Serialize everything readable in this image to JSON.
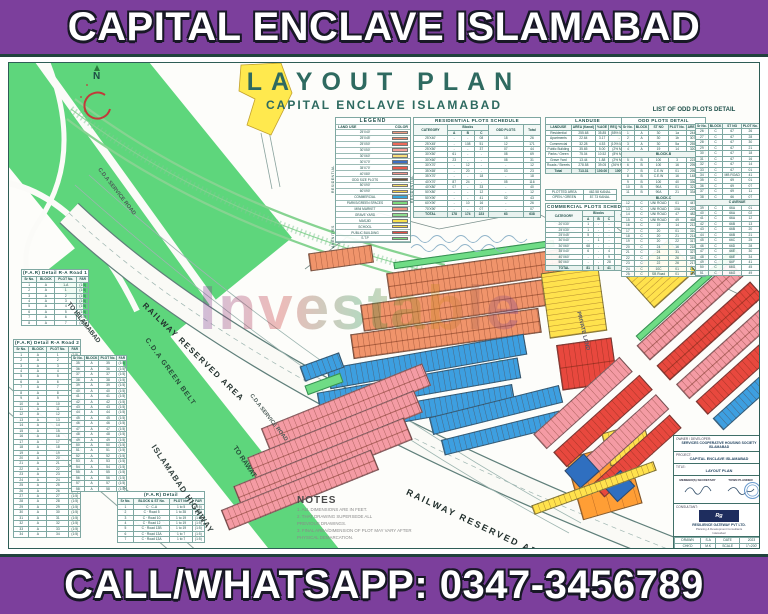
{
  "colors": {
    "banner_purple": "#7c3f9c",
    "frame_teal": "#2e5d56",
    "title_teal": "#2e6a60",
    "belt_green": "#5ed67c",
    "plot_orange": "#F0946B",
    "plot_blue": "#3D9FE0",
    "plot_yellow": "#FFE24D",
    "plot_pink": "#F49BA4",
    "plot_red": "#E8483E",
    "commercial_blue": "#2F6FC0",
    "parcel_orange": "#FF9E35"
  },
  "header": {
    "title": "CAPITAL ENCLAVE ISLAMABAD"
  },
  "footer": {
    "phone_line": "CALL/WHATSAPP: 0347-3456789"
  },
  "map": {
    "title": "LAYOUT PLAN",
    "subtitle": "CAPITAL ENCLAVE ISLAMABAD",
    "north_label": "N",
    "watermark": "Investable",
    "labels": {
      "to_islamabad": "TO ISLAMABAD",
      "service_road_upper": "C.D.A  SERVICE  ROAD",
      "railway_upper": "RAILWAY RESERVED AREA",
      "green_belt": "C.D.A  GREEN  BELT",
      "to_rawat": "TO RAWAT",
      "highway": "ISLAMABAD  HIGHWAY",
      "service_road_lower": "C.D.A  SERVICE  ROAD",
      "railway_lower": "RAILWAY RESERVED AREA",
      "private_land": "PRIVATE LAND"
    }
  },
  "legend": {
    "title": "LEGEND",
    "col1": "LAND USE",
    "col2": "COLOR",
    "group_residential": "RESIDENTIAL",
    "group_amenities": "AMENITIES",
    "rows": [
      {
        "label": "25'X40'",
        "color": "#F29B83"
      },
      {
        "label": "25'X45'",
        "color": "#F28F76"
      },
      {
        "label": "25'X50'",
        "color": "#EE6A5A"
      },
      {
        "label": "30'X50'",
        "color": "#F4A09A"
      },
      {
        "label": "30'X60'",
        "color": "#F7DE7A"
      },
      {
        "label": "30'X70'",
        "color": "#3D6FC2"
      },
      {
        "label": "35'X70'",
        "color": "#E85C4E"
      },
      {
        "label": "40'X80'",
        "color": "#F2978D"
      },
      {
        "label": "ODD SIZE PLOTS",
        "color": "#6B5335"
      },
      {
        "label": "50'X90'",
        "color": "#F7E06A"
      },
      {
        "label": "60'X90'",
        "color": "#F2D14F"
      },
      {
        "label": "COMMERCIAL",
        "color": "#35A7DC"
      },
      {
        "label": "PARKS/GREEN SPACES",
        "color": "#7CD97C"
      },
      {
        "label": "MINI MARKET",
        "color": "#F2937C"
      },
      {
        "label": "GRAVE YARD",
        "color": "#8FDC8F"
      },
      {
        "label": "MASJID",
        "color": "#F8E14E"
      },
      {
        "label": "SCHOOL",
        "color": "#F7D84A"
      },
      {
        "label": "PUBLIC BUILDING",
        "color": "#E44B41"
      },
      {
        "label": "S.T.P",
        "color": "#7CD97C"
      }
    ]
  },
  "residential_schedule": {
    "title": "RESIDENTIAL PLOTS SCHEDULE",
    "side_label": "RESIDENTIAL",
    "header_top": [
      [
        "CATEGORY",
        1,
        2
      ],
      [
        "Blocks",
        3,
        1
      ],
      [
        "ODD PLOTS",
        1,
        2
      ],
      [
        "Total",
        1,
        2
      ]
    ],
    "columns_sub": [
      "A",
      "B",
      "C"
    ],
    "rows": [
      [
        "25'X40'",
        "-",
        "-",
        "08",
        "18",
        "26"
      ],
      [
        "25'X45'",
        "-",
        "108",
        "51",
        "12",
        "171"
      ],
      [
        "25'X50'",
        "-",
        "-",
        "37",
        "07",
        "44"
      ],
      [
        "30'X50'",
        "61",
        "-",
        "-",
        "08",
        "69"
      ],
      [
        "30'X60'",
        "23",
        "-",
        "-",
        "08",
        "31"
      ],
      [
        "30'X70'",
        "-",
        "12",
        "-",
        "-",
        "12"
      ],
      [
        "35'X65'",
        "-",
        "20",
        "-",
        "03",
        "23"
      ],
      [
        "35'X70'",
        "-",
        "-",
        "18",
        "-",
        "18"
      ],
      [
        "40'X70'",
        "87",
        "24",
        "-",
        "05",
        "116"
      ],
      [
        "40'X80'",
        "07",
        "-",
        "33",
        "-",
        "40"
      ],
      [
        "50'X80'",
        "-",
        "-",
        "12",
        "-",
        "12"
      ],
      [
        "50'X90'",
        "-",
        "-",
        "41",
        "02",
        "43"
      ],
      [
        "60'X90'",
        "-",
        "10",
        "16",
        "-",
        "26"
      ],
      [
        "70'X90'",
        "-",
        "-",
        "07",
        "-",
        "07"
      ]
    ],
    "total_row": [
      "TOTAL",
      "178",
      "174",
      "223",
      "63",
      "638"
    ]
  },
  "landuse_table": {
    "title": "LANDUSE",
    "columns": [
      "LANDUSE",
      "AREA (Kanal)",
      "%AGE",
      "REQ %AGE"
    ],
    "rows": [
      [
        "Residential",
        "255.68",
        "35.85",
        "(55% MAX)"
      ],
      [
        "Apartments",
        "22.64",
        "3.17",
        "-"
      ],
      [
        "Commercial",
        "32.28",
        "4.53",
        "(10% MAX)"
      ],
      [
        "Public Building",
        "35.65",
        "5.00",
        "(2% MIN)"
      ],
      [
        "Parks / Green",
        "75.04",
        "10.52",
        "(8% MIN)"
      ],
      [
        "Grave Yard",
        "13.44",
        "1.88",
        "(2% MIN)"
      ],
      [
        "Roads / Streets",
        "278.58",
        "39.05",
        "(26% MIN)"
      ]
    ],
    "total_row": [
      "Total",
      "713.31",
      "100.00",
      "100%"
    ]
  },
  "landuse_summary": {
    "rows": [
      [
        "PLOTTED AREA",
        "462.58 KANAL"
      ],
      [
        "OPEN / GREEN",
        "87.73 KANAL"
      ]
    ]
  },
  "commercial_schedule": {
    "title": "COMMERCIAL PLOTS SCHEDULE",
    "header_top": [
      [
        "CATEGORY",
        1,
        2
      ],
      [
        "Blocks",
        3,
        1
      ],
      [
        "Total",
        1,
        2
      ]
    ],
    "columns_sub": [
      "A",
      "B",
      "C"
    ],
    "rows": [
      [
        "20'X30'",
        "1",
        "-",
        "-",
        "1"
      ],
      [
        "25'X30'",
        "1",
        "-",
        "-",
        "1"
      ],
      [
        "25'X45'",
        "5",
        "-",
        "-",
        "5"
      ],
      [
        "30'X40'",
        "-",
        "1",
        "-",
        "1"
      ],
      [
        "30'X60'",
        "68",
        "-",
        "-",
        "68"
      ],
      [
        "35'X40'",
        "6",
        "-",
        "4",
        "10"
      ],
      [
        "40'X60'",
        "-",
        "-",
        "9",
        "9"
      ],
      [
        "50'X60'",
        "-",
        "-",
        "28",
        "28"
      ]
    ],
    "total_row": [
      "TOTAL",
      "81",
      "1",
      "41",
      "123"
    ]
  },
  "odd_plots": {
    "heading": "LIST OF ODD PLOTS DETAIL",
    "left": {
      "title": "ODD PLOTS DETAIL",
      "columns": [
        "Sr No.",
        "BLOCK",
        "ST NO",
        "PLOT No.",
        "AREA (sft)"
      ],
      "rows": [
        [
          "1",
          "A",
          "30",
          "1a",
          "2445.04"
        ],
        [
          "2",
          "A",
          "30",
          "1b",
          "3079.97"
        ],
        [
          "3",
          "A",
          "30",
          "5a",
          "2553.45"
        ],
        [
          "4",
          "A",
          "19",
          "14",
          "3200.47"
        ],
        "BLOCK-B",
        [
          "5",
          "B",
          "100",
          "3",
          "2230.16"
        ],
        [
          "6",
          "B",
          "100",
          "16",
          "2953.35"
        ],
        [
          "7",
          "B",
          "C.E.W",
          "01",
          "2954.34"
        ],
        [
          "8",
          "B",
          "C.E.W",
          "16",
          "1483.46"
        ],
        [
          "9",
          "B",
          "100",
          "40",
          "3360.71"
        ],
        [
          "10",
          "B",
          "90A",
          "01",
          "3211.68"
        ],
        [
          "11",
          "B",
          "90A",
          "21",
          "3340.25"
        ],
        "BLOCK-C",
        [
          "12",
          "C",
          "UNI ROAD",
          "01",
          "4476.21"
        ],
        [
          "13",
          "C",
          "UNI ROAD",
          "10A",
          "2294.60"
        ],
        [
          "14",
          "C",
          "UNI ROAD",
          "47",
          "4824.27"
        ],
        [
          "15",
          "C",
          "UNI ROAD",
          "49",
          "4680.02"
        ],
        [
          "16",
          "C",
          "19",
          "14",
          "2129.24"
        ],
        [
          "17",
          "C",
          "20",
          "01",
          "3108.47"
        ],
        [
          "18",
          "C",
          "20",
          "21",
          "2149.54"
        ],
        [
          "19",
          "C",
          "20",
          "22",
          "3176.41"
        ],
        [
          "20",
          "C",
          "24",
          "16",
          "2180.73"
        ],
        [
          "21",
          "C",
          "24",
          "31",
          "3276.18"
        ],
        [
          "22",
          "C",
          "24",
          "26",
          "3496.96"
        ],
        [
          "23",
          "C",
          "22",
          "26",
          "2176.31"
        ],
        [
          "24",
          "C",
          "10C",
          "01",
          "1504.65"
        ],
        [
          "25",
          "C",
          "SB Road",
          "01",
          "1318.81"
        ]
      ]
    },
    "right": {
      "columns": [
        "Sr No.",
        "BLOCK",
        "ST NO",
        "PLOT No.",
        "AREA (sft)"
      ],
      "rows": [
        [
          "26",
          "C",
          "67",
          "26",
          "5179.02"
        ],
        [
          "27",
          "C",
          "67",
          "28",
          "3117.96"
        ],
        [
          "28",
          "C",
          "67",
          "30",
          "3178.42"
        ],
        [
          "29",
          "C",
          "67",
          "21",
          "3157.98"
        ],
        [
          "30",
          "C",
          "67",
          "18",
          "3178.41"
        ],
        [
          "31",
          "C",
          "67",
          "16",
          "2177.59"
        ],
        [
          "32",
          "C",
          "67",
          "14",
          "3178.45"
        ],
        [
          "33",
          "C",
          "67",
          "01",
          "4482.83"
        ],
        [
          "34",
          "C",
          "MB ROAD",
          "41",
          "4678.21"
        ],
        [
          "35",
          "C",
          "69",
          "01",
          "4478.48"
        ],
        [
          "36",
          "C",
          "69",
          "07",
          "4678.77"
        ],
        [
          "37",
          "C",
          "69",
          "11",
          "2468.18"
        ],
        [
          "38",
          "C",
          "66",
          "07",
          "3676.84"
        ],
        "C AVENUE",
        [
          "39",
          "C",
          "66A",
          "01",
          "676"
        ],
        [
          "40",
          "C",
          "66A",
          "02",
          "596"
        ],
        [
          "41",
          "C",
          "66A",
          "12",
          "508"
        ],
        [
          "42",
          "C",
          "66B",
          "13",
          "506"
        ],
        [
          "43",
          "C",
          "66B",
          "20",
          "508"
        ],
        [
          "44",
          "C",
          "66B",
          "21",
          "528"
        ],
        [
          "45",
          "C",
          "66C",
          "25",
          "508"
        ],
        [
          "46",
          "C",
          "66D",
          "28",
          "566"
        ],
        [
          "47",
          "C",
          "66E",
          "30",
          "572"
        ],
        [
          "48",
          "C",
          "66E",
          "34",
          "580"
        ],
        [
          "49",
          "C",
          "66F",
          "41",
          "587"
        ],
        [
          "50",
          "C",
          "66G",
          "45",
          "592"
        ],
        [
          "51",
          "C",
          "66G",
          "49",
          "5928"
        ]
      ]
    }
  },
  "far_road1": {
    "title": "(F.A.R) Detail  R-A Road 1",
    "columns": [
      "Sr No.",
      "BLOCK",
      "PLOT No.",
      "FAR"
    ],
    "rows": [
      [
        "1",
        "A",
        "1-A",
        "(1:5)"
      ],
      [
        "2",
        "A",
        "1",
        "(1:5)"
      ],
      [
        "3",
        "A",
        "2",
        "(1:5)"
      ],
      [
        "4",
        "A",
        "3",
        "(1:5)"
      ],
      [
        "5",
        "A",
        "4",
        "(1:5)"
      ],
      [
        "6",
        "A",
        "5",
        "(1:5)"
      ],
      [
        "7",
        "A",
        "6",
        "(1:5)"
      ],
      [
        "8",
        "A",
        "7",
        "(1:5)"
      ]
    ]
  },
  "far_road2": {
    "title": "(F.A.R) Detail  R-A Road 2",
    "columns": [
      "Sr No.",
      "BLOCK",
      "PLOT No.",
      "FAR"
    ],
    "rows": [
      [
        "1",
        "A",
        "1",
        "(1:5)"
      ],
      [
        "2",
        "A",
        "2",
        "(1:5)"
      ],
      [
        "3",
        "A",
        "3",
        "(1:5)"
      ],
      [
        "4",
        "A",
        "4",
        "(1:5)"
      ],
      [
        "5",
        "A",
        "5",
        "(1:5)"
      ],
      [
        "6",
        "A",
        "6",
        "(1:5)"
      ],
      [
        "7",
        "A",
        "7",
        "(1:5)"
      ],
      [
        "8",
        "A",
        "8",
        "(1:5)"
      ],
      [
        "9",
        "A",
        "9",
        "(1:5)"
      ],
      [
        "10",
        "A",
        "10",
        "(1:5)"
      ],
      [
        "11",
        "A",
        "11",
        "(1:5)"
      ],
      [
        "12",
        "A",
        "12",
        "(1:5)"
      ],
      [
        "13",
        "A",
        "13",
        "(1:5)"
      ],
      [
        "14",
        "A",
        "14",
        "(1:5)"
      ],
      [
        "15",
        "A",
        "15",
        "(1:5)"
      ],
      [
        "16",
        "A",
        "16",
        "(1:5)"
      ],
      [
        "17",
        "A",
        "17",
        "(1:5)"
      ],
      [
        "18",
        "A",
        "18",
        "(1:5)"
      ],
      [
        "19",
        "A",
        "19",
        "(1:5)"
      ],
      [
        "20",
        "A",
        "20",
        "(1:5)"
      ],
      [
        "21",
        "A",
        "21",
        "(1:5)"
      ],
      [
        "22",
        "A",
        "22",
        "(1:5)"
      ],
      [
        "23",
        "A",
        "23",
        "(1:5)"
      ],
      [
        "24",
        "A",
        "24",
        "(1:5)"
      ],
      [
        "25",
        "A",
        "25",
        "(1:5)"
      ],
      [
        "26",
        "A",
        "26",
        "(1:5)"
      ],
      [
        "27",
        "A",
        "27",
        "(1:5)"
      ],
      [
        "28",
        "A",
        "28",
        "(1:5)"
      ],
      [
        "29",
        "A",
        "29",
        "(1:5)"
      ],
      [
        "30",
        "A",
        "30",
        "(1:5)"
      ],
      [
        "31",
        "A",
        "31",
        "(1:5)"
      ],
      [
        "32",
        "A",
        "32",
        "(1:5)"
      ],
      [
        "33",
        "A",
        "33",
        "(1:5)"
      ],
      [
        "34",
        "A",
        "34",
        "(1:5)"
      ]
    ]
  },
  "far_road2b": {
    "columns": [
      "Sr No.",
      "BLOCK",
      "PLOT No.",
      "FAR"
    ],
    "rows": [
      [
        "35",
        "A",
        "35",
        "(1:5)"
      ],
      [
        "36",
        "A",
        "36",
        "(1:5)"
      ],
      [
        "37",
        "A",
        "37",
        "(1:5)"
      ],
      [
        "38",
        "A",
        "38",
        "(1:5)"
      ],
      [
        "39",
        "A",
        "39",
        "(1:5)"
      ],
      [
        "40",
        "A",
        "40",
        "(1:5)"
      ],
      [
        "41",
        "A",
        "41",
        "(1:5)"
      ],
      [
        "42",
        "A",
        "42",
        "(1:5)"
      ],
      [
        "43",
        "A",
        "43",
        "(1:5)"
      ],
      [
        "44",
        "A",
        "44",
        "(1:5)"
      ],
      [
        "45",
        "A",
        "45",
        "(1:5)"
      ],
      [
        "46",
        "A",
        "46",
        "(1:5)"
      ],
      [
        "47",
        "A",
        "47",
        "(1:5)"
      ],
      [
        "48",
        "A",
        "48",
        "(1:5)"
      ],
      [
        "49",
        "A",
        "49",
        "(1:5)"
      ],
      [
        "50",
        "A",
        "50",
        "(1:5)"
      ],
      [
        "51",
        "A",
        "51",
        "(1:5)"
      ],
      [
        "52",
        "A",
        "52",
        "(1:5)"
      ],
      [
        "53",
        "A",
        "53",
        "(1:5)"
      ],
      [
        "54",
        "A",
        "54",
        "(1:5)"
      ],
      [
        "55",
        "A",
        "55",
        "(1:5)"
      ],
      [
        "56",
        "A",
        "56",
        "(1:5)"
      ],
      [
        "57",
        "A",
        "57",
        "(1:5)"
      ],
      [
        "58",
        "A",
        "58",
        "(1:5)"
      ]
    ]
  },
  "far_block_c": {
    "title": "(F.A.R) Detail",
    "columns": [
      "Sr No.",
      "BLOCK & ST No.",
      "PLOT No.",
      "FAR"
    ],
    "rows": [
      [
        "1",
        "C · C-A",
        "1 to 5",
        "(1:5)"
      ],
      [
        "2",
        "C · Road 5",
        "1 to 35",
        "(1:5)"
      ],
      [
        "3",
        "C · Road 10",
        "1 to 19",
        "(1:5)"
      ],
      [
        "4",
        "C · Road 12",
        "1 to 19",
        "(1:5)"
      ],
      [
        "5",
        "C · Road 13B",
        "1 to 19",
        "(1:5)"
      ],
      [
        "6",
        "C · Road 13A",
        "1 to 7",
        "(1:5)"
      ],
      [
        "7",
        "C · Road 13A",
        "1 to 7",
        "(1:5)"
      ]
    ]
  },
  "notes": {
    "title": "NOTES",
    "items": [
      "1.  ALL DIMENSIONS ARE IN FEET.",
      "2.  THAT DRAWING SUPERSEDE ALL",
      "     PREVIOUS DRAWINGS.",
      "3.  FINAL AREA/DIMENSION OF PLOT MAY VARY AFTER",
      "     PHYSICAL DEMARCATION."
    ]
  },
  "title_block": {
    "owner_label": "OWNER / DEVELOPER:",
    "owner_value": "SERVICES COOPERATIVE HOUSING SOCIETY ISLAMABAD",
    "project_label": "PROJECT:",
    "project_value": "CAPITAL ENCLAVE ISLAMABAD",
    "title_label": "TITLE:",
    "title_value": "LAYOUT PLAN",
    "sig_left": "MEMBER(S) SECRETARY",
    "sig_right": "TOWN PLANNER",
    "consultant_label": "CONSULTANT:",
    "consultant_logo": "Rg",
    "consultant_name": "RESILIENCE GATEWAY PVT LTD.",
    "consultant_sub1": "Planning & Development Consultants",
    "consultant_sub2": "Islamabad",
    "grid": {
      "columns": [
        "",
        "",
        "",
        ""
      ],
      "rows": [
        [
          "DRAWN",
          "S.A",
          "DATE",
          "2023"
        ],
        [
          "CHK'D",
          "M.K",
          "SCALE",
          "1\"=200'"
        ],
        [
          "APP'D",
          "T.P",
          "SHEET",
          "01"
        ]
      ]
    }
  }
}
